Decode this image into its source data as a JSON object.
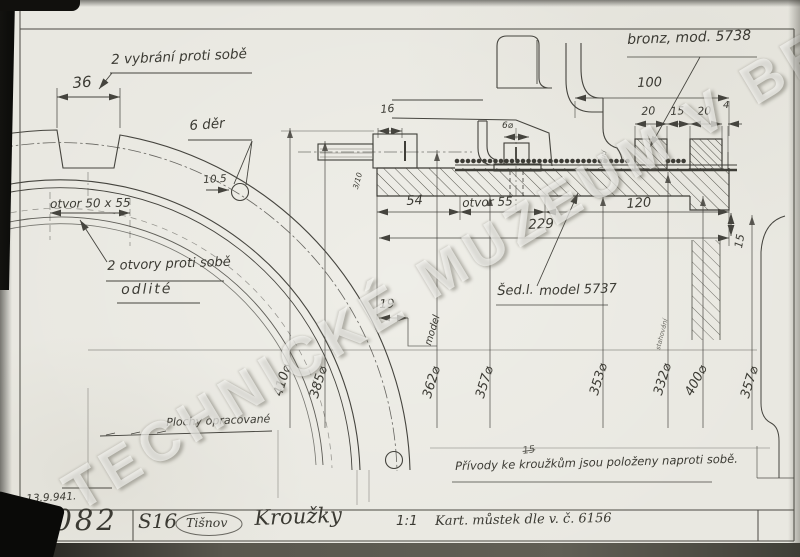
{
  "watermark": "TECHNICKÉ MUZEUM V BRNĚ",
  "left_view": {
    "recess_note": "2 vybrání proti sobě",
    "recess_width": "36",
    "holes_note": "6 děr",
    "hole_dia": "10.5",
    "opening_dim": "otvor 50 x 55",
    "cast_holes_note_line1": "2 otvory proti sobě",
    "cast_holes_note_line2": "odlité",
    "machined_note": "Plochy opracované"
  },
  "section_view": {
    "bronze_note": "bronz, mod. 5738",
    "grey_iron_abbrev": "Šed.l.",
    "grey_iron_model": "model 5737",
    "model_word": "model",
    "winding_note": "vinutí",
    "turning_note": "stahování",
    "dims": {
      "total_top": "100",
      "ring1": "20",
      "gap": "15",
      "ring2": "20",
      "edge": "4",
      "boss": "16",
      "bolt": "6⌀",
      "tolerance": "3/10",
      "left": "54",
      "opening": "otvor 55",
      "right": "120",
      "total": "229",
      "step": "15",
      "offset": "19"
    },
    "diameters": [
      "410⌀",
      "385⌀",
      "362⌀",
      "357⌀",
      "353⌀",
      "332⌀",
      "400⌀",
      "357⌀"
    ]
  },
  "footer": {
    "leads_note": "Přívody ke kroužkům jsou položeny naproti sobě.",
    "scribble": "15",
    "date": "13.9.941.",
    "drawing_number": "6082",
    "plant": "S16",
    "location": "Tišnov",
    "title": "Kroužky",
    "scale": "1:1",
    "reference": "Kart. můstek dle v. č. 6156"
  }
}
